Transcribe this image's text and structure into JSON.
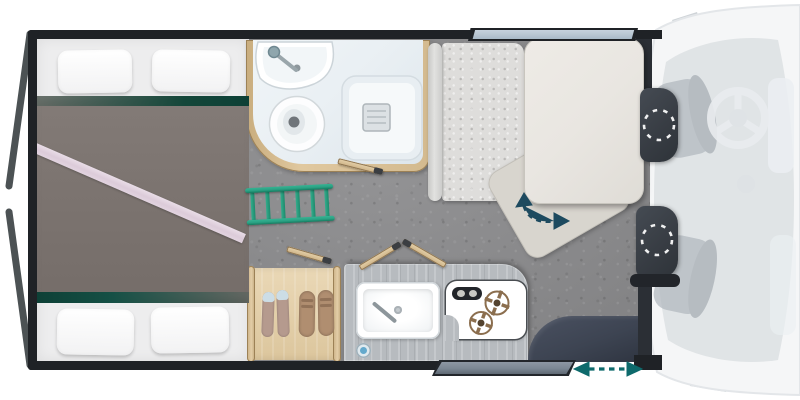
{
  "floorplan": {
    "type": "campervan-floorplan",
    "areas": {
      "rear_bed": {
        "label": "Rear bed"
      },
      "bathroom": {
        "label": "Bathroom"
      },
      "wardrobe": {
        "label": "Wardrobe with shoe storage"
      },
      "kitchen": {
        "label": "Kitchen"
      },
      "dinette": {
        "label": "Dinette seating area"
      },
      "cab": {
        "label": "Driver cab"
      }
    },
    "fixtures": {
      "pillows": {
        "label": "Pillow",
        "count": 4
      },
      "washbasin": {
        "label": "Washbasin"
      },
      "toilet": {
        "label": "Toilet"
      },
      "shower": {
        "label": "Shower tray"
      },
      "ladder": {
        "label": "Ladder"
      },
      "shoes": {
        "label": "Shoes",
        "pairs": 2
      },
      "sink": {
        "label": "Kitchen sink"
      },
      "hob": {
        "label": "Gas hob",
        "burner_count": 2
      },
      "table": {
        "label": "Swivel table"
      },
      "bench": {
        "label": "Bench seat"
      },
      "swivel_seat_front": {
        "label": "Swivelled cab seat (driver side)"
      },
      "swivel_seat_rear": {
        "label": "Swivelled cab seat (passenger side)"
      },
      "sliding_door": {
        "label": "Sliding entry door"
      },
      "window": {
        "label": "Window"
      },
      "steering_wheel": {
        "label": "Steering wheel"
      },
      "wing_mirrors": {
        "label": "Wing mirror",
        "count": 2
      },
      "rear_doors": {
        "label": "Open rear door",
        "count": 2
      }
    },
    "indicators": {
      "table_rotation": {
        "label": "Table swivel direction arrow"
      },
      "door_slide": {
        "label": "Door slide direction arrow"
      },
      "seat_rotation": {
        "label": "Seat swivel arc"
      }
    }
  },
  "colors": {
    "wall": "#1f2226",
    "floor": "#8d8d8f",
    "duvet": "#7c7470",
    "mattress": "#ededee",
    "pillow": "#f2f2f3",
    "bed_stripe_green": "#0d4036",
    "bed_runner_pink": "#dccbd9",
    "wood": "#d9c198",
    "wood_edge": "#9c8156",
    "bath_floor": "#e9eff3",
    "counter": "#b7bbbf",
    "hob_bronze": "#8b6e4e",
    "table": "#e9e6e1",
    "table_ghost": "#d8d5ce",
    "bench": "#dedddb",
    "seat_dark": "#383d44",
    "seat_trim": "#22252a",
    "step_dark": "#3d4452",
    "arrow_teal": "#0e6a6c",
    "arrow_blue": "#1d4a5f",
    "ladder": "#2aa183",
    "glass": "#b9c7d3",
    "door_bar": "#7b8793",
    "van_body": "#f5f6f7",
    "van_line": "#dfe3e7",
    "cab_inner": "#ccd1d6",
    "faucet_blue": "#64a9cc"
  }
}
